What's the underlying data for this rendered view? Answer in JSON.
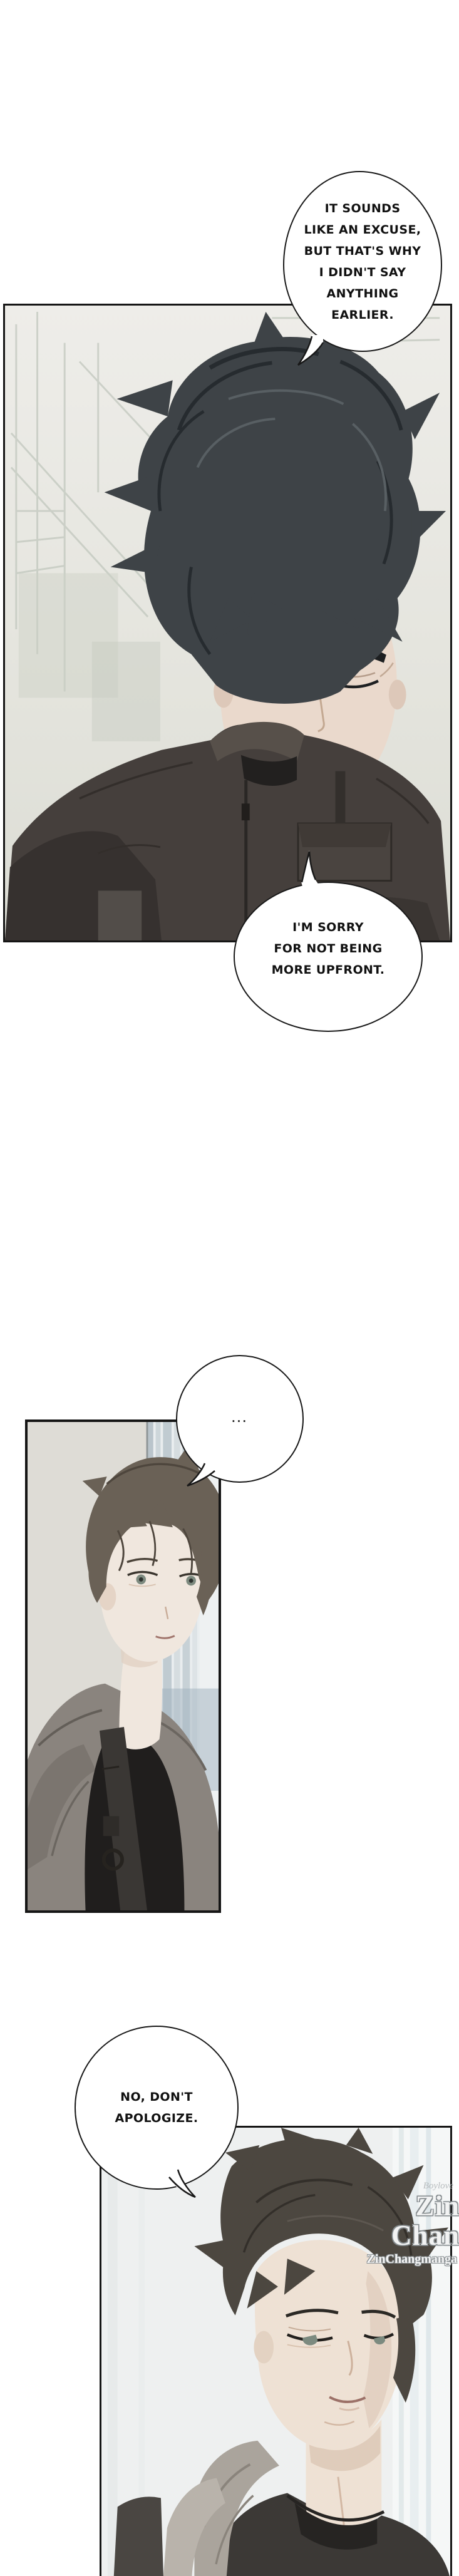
{
  "speech": {
    "b1": {
      "lines": [
        "IT SOUNDS",
        "LIKE AN EXCUSE,",
        "BUT THAT'S WHY",
        "I DIDN'T SAY",
        "ANYTHING",
        "EARLIER."
      ]
    },
    "b2": {
      "lines": [
        "I'M SORRY",
        "FOR NOT BEING",
        "MORE UPFRONT."
      ]
    },
    "b3": {
      "lines": [
        "..."
      ]
    },
    "b4": {
      "lines": [
        "NO, DON'T",
        "APOLOGIZE."
      ]
    }
  },
  "watermark": {
    "small": "Boylove",
    "main": "Zin Chan",
    "sub": "ZinChangmanga"
  },
  "colors": {
    "page_bg": "#ffffff",
    "panel_border": "#151515",
    "bubble_stroke": "#181818",
    "panel1_bg": "#e9e8e3",
    "panel2_wall": "#dedcd6",
    "panel3_bg": "#eef0f0",
    "man1_hair": "#3e4347",
    "man1_jacket": "#453f3c",
    "man2_hair": "#6a6156",
    "man2_hoodie": "#8a847e",
    "man3_hair": "#4c4740",
    "skin": "#eee1d4",
    "watermark_outline": "#868c8f"
  }
}
